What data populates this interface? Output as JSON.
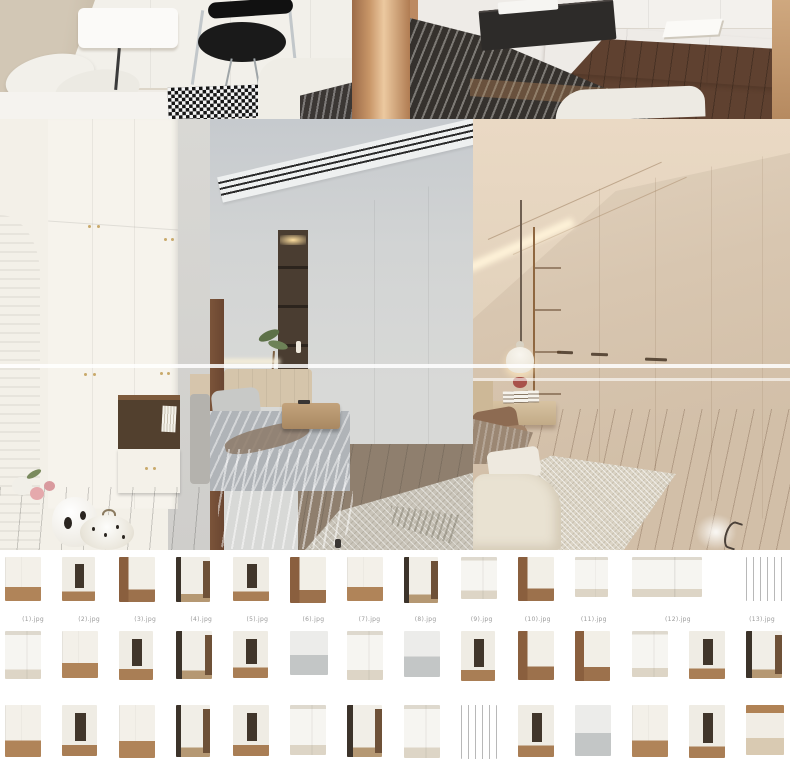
{
  "collage": {
    "top_row": [
      {
        "id": "bedroom-desk-chair",
        "label": "bedroom corner with white desk, black chair and houndstooth rug"
      },
      {
        "id": "bedroom-striped-bed",
        "label": "bedroom with dark striped duvet and white floating sideboard"
      }
    ],
    "main_row": [
      {
        "id": "white-wardrobe-arch",
        "label": "white wardrobe with wood arch pillar, vase and pumpkin decor"
      },
      {
        "id": "grey-bedroom-wardrobe",
        "label": "grey bedroom with white wardrobe, dark shelf niche and linear vent"
      },
      {
        "id": "beige-bedroom-wardrobe",
        "label": "beige bedroom with cream wardrobe, pendant lamp and floating nightstand"
      }
    ]
  },
  "colors": {
    "page_background": "#ffffff",
    "glare_line": "#ffffff",
    "wood_accent": "#a9774e",
    "wardrobe_cream": "#ecdfc8",
    "wardrobe_white": "#f6f3ec",
    "knob_gold": "#c9a96b"
  },
  "thumbnails": {
    "cell_width": 57,
    "rows": [
      [
        {
          "tone": "t-whitefloor",
          "w": 36,
          "h": 44,
          "span": 1,
          "caption": "(1).jpg"
        },
        {
          "tone": "t-niche",
          "w": 33,
          "h": 44,
          "span": 1,
          "caption": "(2).jpg"
        },
        {
          "tone": "t-woodside",
          "w": 36,
          "h": 45,
          "span": 1,
          "caption": "(3).jpg"
        },
        {
          "tone": "t-hall",
          "w": 34,
          "h": 45,
          "span": 1,
          "caption": "(4).jpg"
        },
        {
          "tone": "t-niche",
          "w": 36,
          "h": 44,
          "span": 1,
          "caption": "(5).jpg"
        },
        {
          "tone": "t-woodside",
          "w": 36,
          "h": 46,
          "span": 1,
          "caption": "(6).jpg"
        },
        {
          "tone": "t-whitefloor",
          "w": 36,
          "h": 44,
          "span": 1,
          "caption": "(7).jpg"
        },
        {
          "tone": "t-hall",
          "w": 34,
          "h": 46,
          "span": 1,
          "caption": "(8).jpg"
        },
        {
          "tone": "t-bright",
          "w": 36,
          "h": 42,
          "span": 1,
          "caption": "(9).jpg"
        },
        {
          "tone": "t-woodside",
          "w": 36,
          "h": 44,
          "span": 1,
          "caption": "(10).jpg"
        },
        {
          "tone": "t-bright",
          "w": 33,
          "h": 40,
          "span": 1,
          "caption": "(11).jpg"
        },
        {
          "tone": "t-bright",
          "w": 70,
          "h": 40,
          "span": 2,
          "caption": "(12).jpg"
        },
        {
          "tone": "t-darkcab",
          "w": 38,
          "h": 44,
          "span": 1,
          "caption": "(13).jpg"
        }
      ],
      [
        {
          "tone": "t-bright",
          "w": 36,
          "h": 48,
          "span": 1
        },
        {
          "tone": "t-whitefloor",
          "w": 36,
          "h": 47,
          "span": 1
        },
        {
          "tone": "t-niche",
          "w": 34,
          "h": 49,
          "span": 1
        },
        {
          "tone": "t-hall",
          "w": 36,
          "h": 48,
          "span": 1
        },
        {
          "tone": "t-niche",
          "w": 35,
          "h": 47,
          "span": 1
        },
        {
          "tone": "t-gray",
          "w": 38,
          "h": 44,
          "span": 1
        },
        {
          "tone": "t-bright",
          "w": 36,
          "h": 49,
          "span": 1
        },
        {
          "tone": "t-gray",
          "w": 36,
          "h": 46,
          "span": 1
        },
        {
          "tone": "t-niche",
          "w": 34,
          "h": 50,
          "span": 1
        },
        {
          "tone": "t-woodside",
          "w": 36,
          "h": 49,
          "span": 1
        },
        {
          "tone": "t-woodside",
          "w": 35,
          "h": 50,
          "span": 1
        },
        {
          "tone": "t-bright",
          "w": 36,
          "h": 46,
          "span": 1
        },
        {
          "tone": "t-niche",
          "w": 36,
          "h": 48,
          "span": 1
        },
        {
          "tone": "t-hall",
          "w": 36,
          "h": 47,
          "span": 1
        }
      ],
      [
        {
          "tone": "t-whitefloor",
          "w": 36,
          "h": 52,
          "span": 1
        },
        {
          "tone": "t-niche",
          "w": 35,
          "h": 51,
          "span": 1
        },
        {
          "tone": "t-whitefloor",
          "w": 36,
          "h": 53,
          "span": 1
        },
        {
          "tone": "t-hall",
          "w": 34,
          "h": 52,
          "span": 1
        },
        {
          "tone": "t-niche",
          "w": 36,
          "h": 51,
          "span": 1
        },
        {
          "tone": "t-bright",
          "w": 36,
          "h": 50,
          "span": 1
        },
        {
          "tone": "t-hall",
          "w": 35,
          "h": 52,
          "span": 1
        },
        {
          "tone": "t-bright",
          "w": 36,
          "h": 53,
          "span": 1
        },
        {
          "tone": "t-darkcab",
          "w": 36,
          "h": 54,
          "span": 1
        },
        {
          "tone": "t-niche",
          "w": 36,
          "h": 52,
          "span": 1
        },
        {
          "tone": "t-gray",
          "w": 36,
          "h": 51,
          "span": 1
        },
        {
          "tone": "t-whitefloor",
          "w": 36,
          "h": 52,
          "span": 1
        },
        {
          "tone": "t-niche",
          "w": 36,
          "h": 53,
          "span": 1
        },
        {
          "tone": "t-bed",
          "w": 38,
          "h": 50,
          "span": 1
        }
      ]
    ]
  }
}
